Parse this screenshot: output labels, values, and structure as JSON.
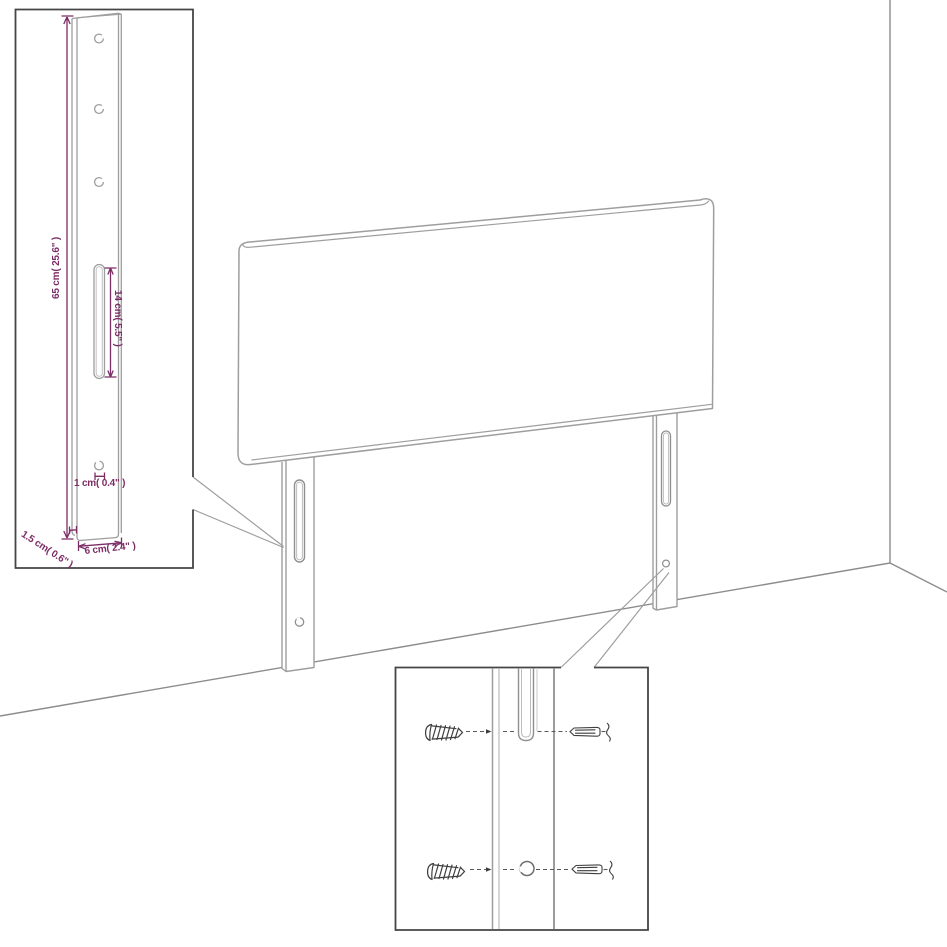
{
  "diagram": {
    "type": "furniture-assembly-dimension-diagram",
    "subject": "headboard with two slotted leg brackets shown in a room corner",
    "colors": {
      "background": "#ffffff",
      "furniture_line": "#9e9e9e",
      "room_line": "#8c8c8c",
      "inset_border": "#454545",
      "hardware_line": "#3f3f3f",
      "dimension_accent": "#7c2d66"
    },
    "leg_detail_inset": {
      "name": "leg bracket dimension detail",
      "labels": {
        "height": "65 cm( 25.6\" )",
        "slot_length": "14 cm( 5.5\" )",
        "hole_diameter": "1 cm( 0.4\" )",
        "thickness": "1.5 cm( 0.6\" )",
        "width": "6 cm( 2.4\" )"
      }
    },
    "hardware_inset": {
      "name": "wall mounting hardware detail",
      "icons": [
        "screw-icon",
        "wall-plug-icon",
        "mounting-slot-icon",
        "mounting-hole-icon"
      ]
    }
  }
}
